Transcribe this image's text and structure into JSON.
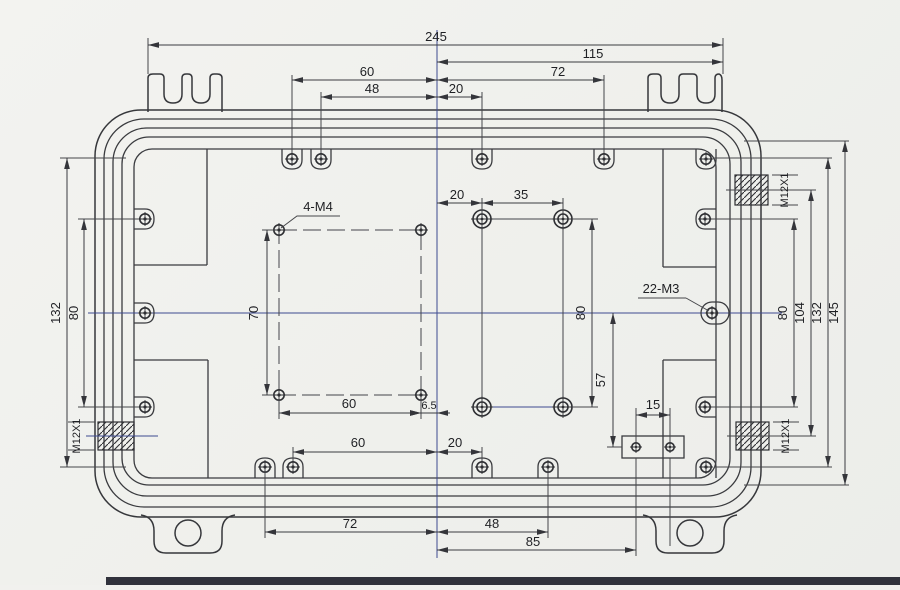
{
  "colors": {
    "paper": "#f1f1ee",
    "ink": "#36373b",
    "centerline_blue": "#3d4a90",
    "scan_strip": "#31323c"
  },
  "dims": {
    "top": {
      "overall": "245",
      "right_half": "115",
      "d60": "60",
      "d72": "72",
      "d48": "48",
      "d20": "20"
    },
    "pattern_right": {
      "d20": "20",
      "d35": "35",
      "d80": "80"
    },
    "pattern_left": {
      "label": "4-M4",
      "d70": "70",
      "d60": "60",
      "offset": "6.5"
    },
    "left": {
      "d132": "132",
      "d80": "80",
      "gland": "M12X1"
    },
    "right": {
      "d80": "80",
      "d104": "104",
      "d132": "132",
      "d145": "145",
      "gland_top": "M12X1",
      "gland_bottom": "M12X1"
    },
    "bottom": {
      "d60": "60",
      "d20": "20",
      "d72": "72",
      "d48": "48",
      "d85": "85"
    },
    "misc": {
      "holes_label": "22-M3",
      "d57": "57",
      "d15": "15"
    }
  }
}
